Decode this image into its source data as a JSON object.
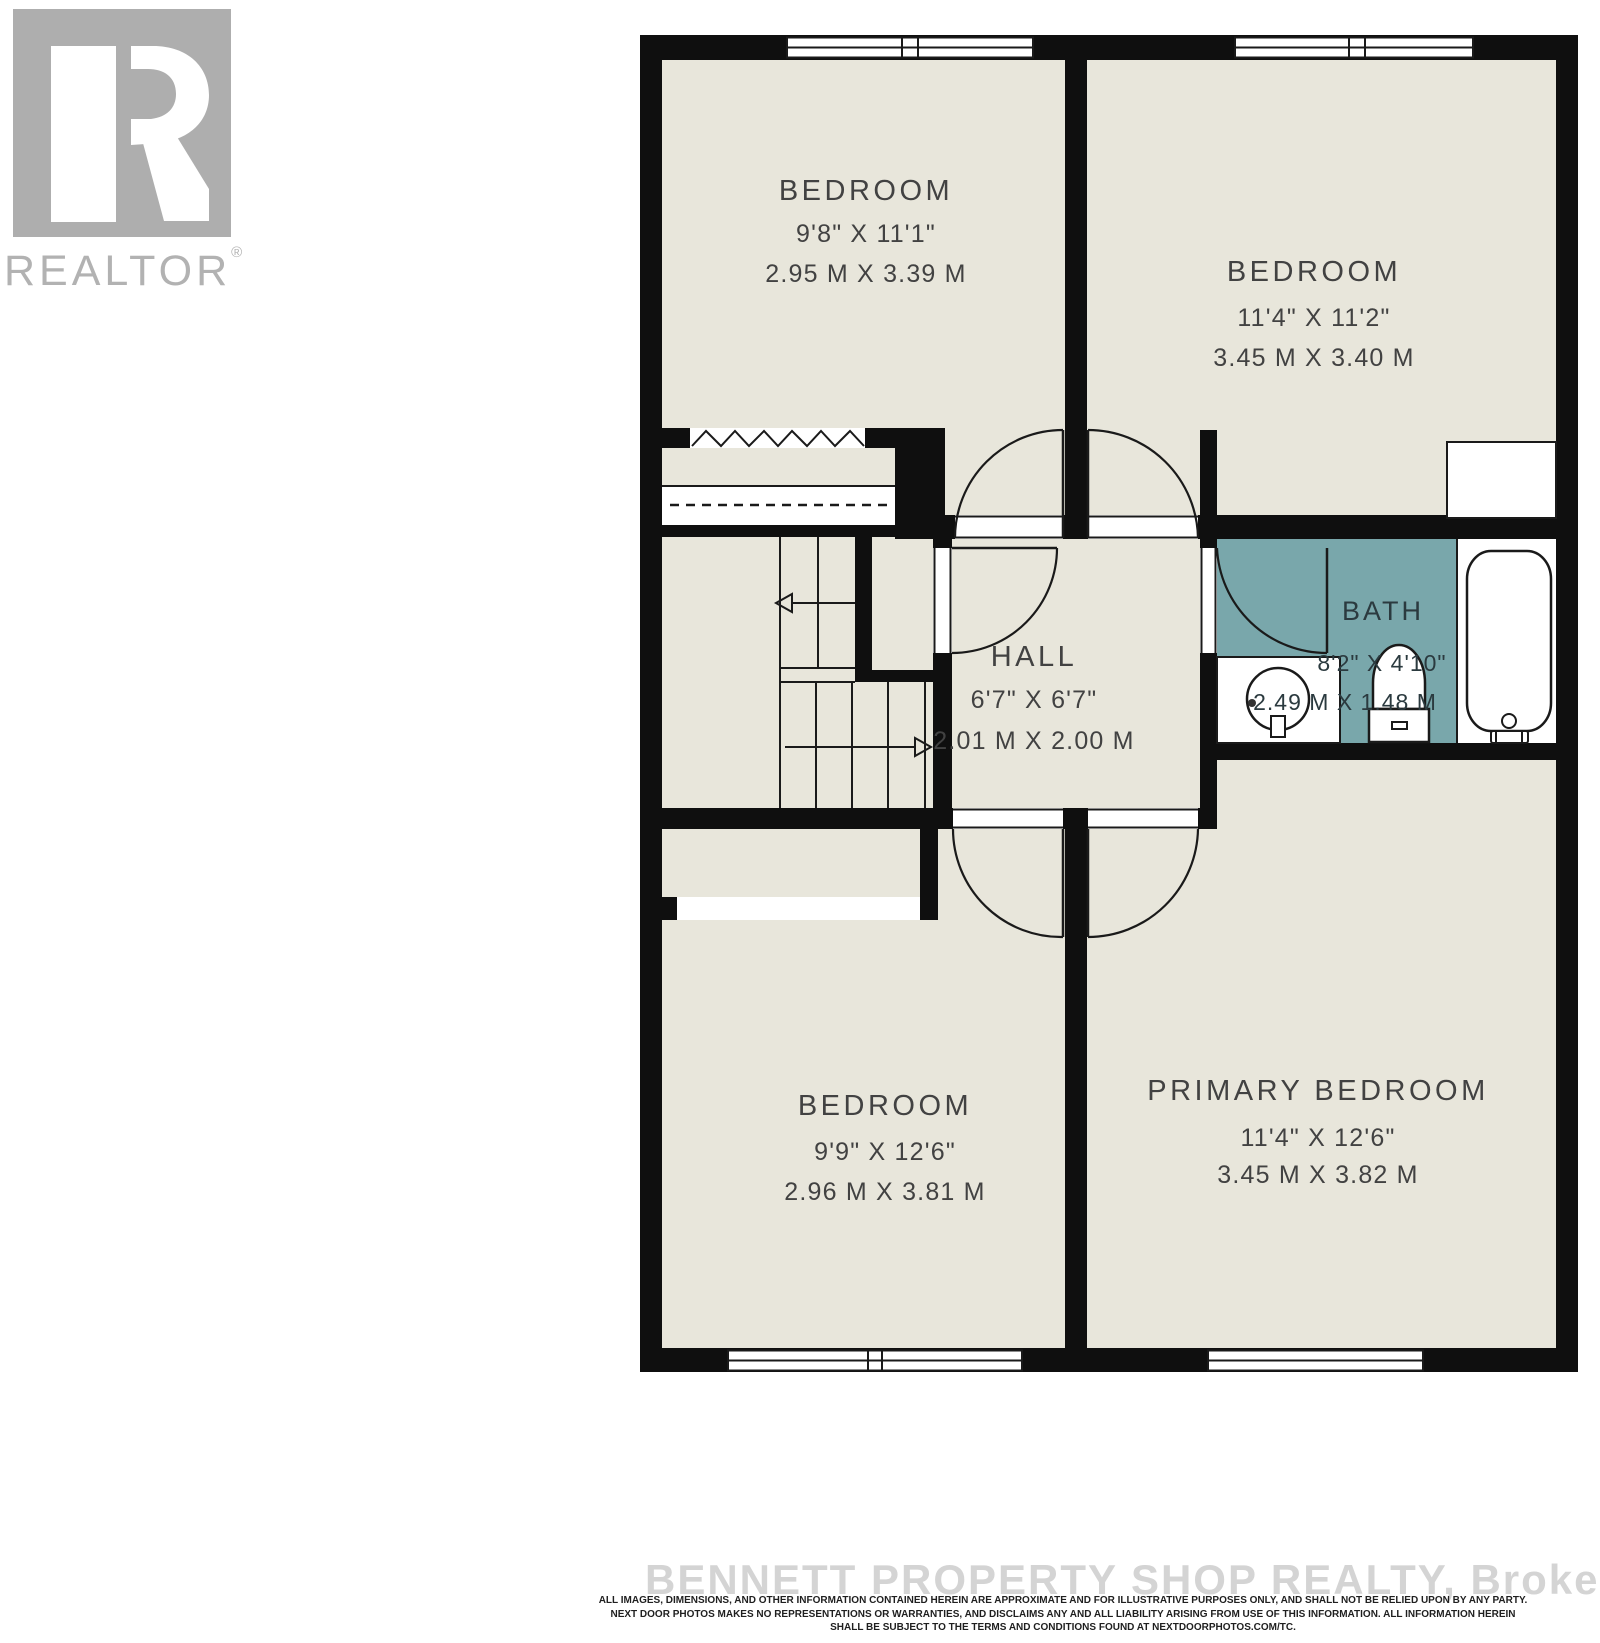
{
  "branding": {
    "logo_text": "REALTOR",
    "registered_mark": "®"
  },
  "colors": {
    "floor": "#e8e6db",
    "wall": "#0f0f0f",
    "bath_floor": "#79a7ab",
    "label_text": "#424242",
    "bath_label_text": "#2b3a3f",
    "logo_gray": "#aeaeae",
    "watermark_text": "#d4d4d4",
    "disclaimer_text": "#1f1f1f"
  },
  "rooms": {
    "bedroom_top_left": {
      "name": "BEDROOM",
      "imperial": "9'8\" X 11'1\"",
      "metric": "2.95 M X 3.39 M"
    },
    "bedroom_top_right": {
      "name": "BEDROOM",
      "imperial": "11'4\" X 11'2\"",
      "metric": "3.45 M X 3.40 M"
    },
    "hall": {
      "name": "HALL",
      "imperial": "6'7\" X 6'7\"",
      "metric": "2.01 M X 2.00 M"
    },
    "bath": {
      "name": "BATH",
      "imperial": "8'2\" X 4'10\"",
      "metric": "2.49 M X 1.48 M"
    },
    "bedroom_bottom_left": {
      "name": "BEDROOM",
      "imperial": "9'9\" X 12'6\"",
      "metric": "2.96 M X 3.81 M"
    },
    "primary_bedroom": {
      "name": "PRIMARY BEDROOM",
      "imperial": "11'4\" X 12'6\"",
      "metric": "3.45 M X 3.82 M"
    }
  },
  "footer": {
    "watermark": "BENNETT PROPERTY SHOP REALTY, Brokerage",
    "disclaimer_line1": "ALL IMAGES, DIMENSIONS, AND OTHER INFORMATION CONTAINED HEREIN ARE APPROXIMATE AND FOR ILLUSTRATIVE PURPOSES ONLY, AND SHALL NOT BE RELIED UPON BY ANY PARTY.",
    "disclaimer_line2": "NEXT DOOR PHOTOS MAKES NO REPRESENTATIONS OR WARRANTIES, AND DISCLAIMS ANY AND ALL LIABILITY ARISING FROM USE OF THIS INFORMATION. ALL INFORMATION HEREIN",
    "disclaimer_line3": "SHALL BE SUBJECT TO THE TERMS AND CONDITIONS FOUND AT NEXTDOORPHOTOS.COM/TC."
  }
}
